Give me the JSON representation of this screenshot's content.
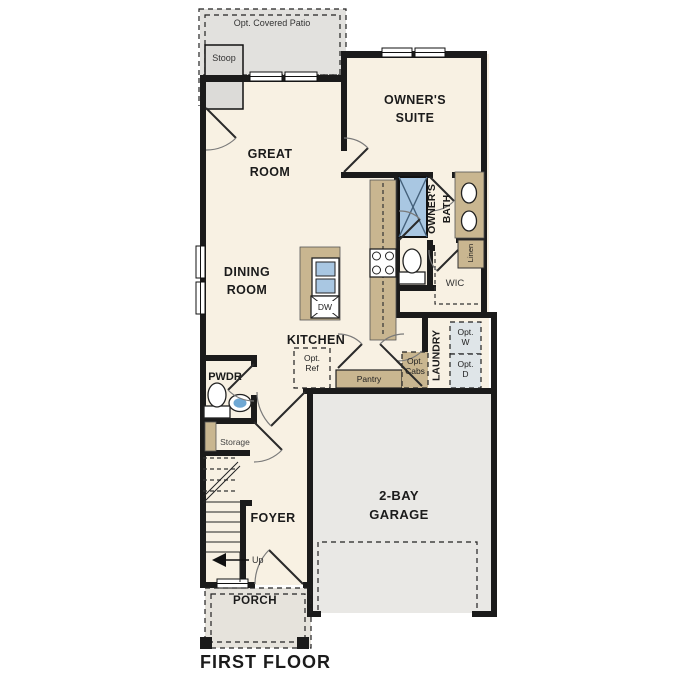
{
  "title": "FIRST FLOOR",
  "colors": {
    "wall": "#1b1b1b",
    "room_cream": "#f8f1e3",
    "cabinet_tan": "#c9b690",
    "patio_gray": "#e2e1de",
    "garage_gray": "#e9e8e5",
    "porch_gray": "#e6e3dc",
    "fixture_blue": "#a9c7e2",
    "fixture_blue_dark": "#44607a"
  },
  "labels": {
    "patio": "Opt. Covered Patio",
    "stoop": "Stoop",
    "great_room": "GREAT\nROOM",
    "owners_suite": "OWNER'S\nSUITE",
    "owners_bath": "OWNER'S\nBATH",
    "linen": "Linen",
    "wic": "WIC",
    "dining_room": "DINING\nROOM",
    "kitchen": "KITCHEN",
    "dishwasher": "DW",
    "opt_ref": "Opt.\nRef",
    "pantry": "Pantry",
    "opt_cabs": "Opt.\nCabs",
    "laundry": "LAUNDRY",
    "opt_washer": "Opt.\nW",
    "opt_dryer": "Opt.\nD",
    "powder": "PWDR",
    "storage": "Storage",
    "foyer": "FOYER",
    "up": "Up",
    "garage": "2-BAY\nGARAGE",
    "porch": "PORCH"
  }
}
